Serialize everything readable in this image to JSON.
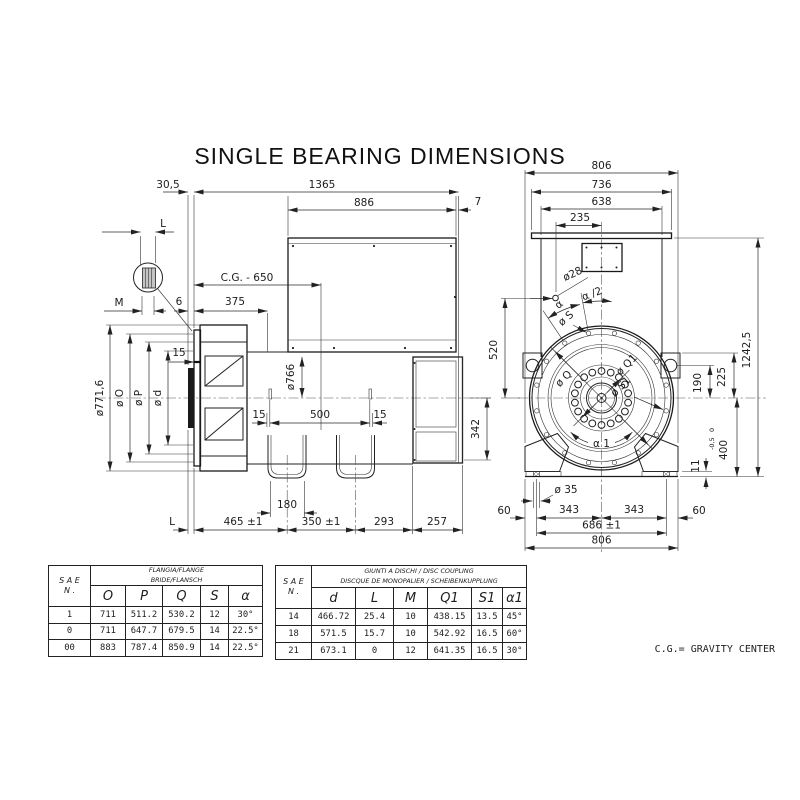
{
  "title": "SINGLE BEARING DIMENSIONS",
  "footer_note": "C.G.= GRAVITY CENTER",
  "side_view": {
    "top": {
      "d30": "30,5",
      "d1365": "1365",
      "d886": "886",
      "d7": "7"
    },
    "mid": {
      "cg": "C.G. - 650",
      "d375": "375",
      "d6": "6",
      "m": "M",
      "l_top": "L",
      "d15_flange": "15",
      "dia766": "ø766",
      "d15_l": "15",
      "d500": "500",
      "d15_r": "15",
      "d342": "342"
    },
    "dia": {
      "d771": "ø771,6",
      "dO": "ø O",
      "dP": "ø P",
      "dd": "ø d"
    },
    "bottom": {
      "d180": "180",
      "l": "L",
      "d465": "465 ±1",
      "d350": "350 ±1",
      "d293": "293",
      "d257": "257"
    }
  },
  "front_view": {
    "top": {
      "d806": "806",
      "d736": "736",
      "d638": "638",
      "d235": "235"
    },
    "left": {
      "dia28": "ø28",
      "d520": "520"
    },
    "angles": {
      "a2": "α /2",
      "a": "α",
      "dS": "ø S",
      "a1": "α 1"
    },
    "flange": {
      "dQ": "ø Q",
      "dQ1": "ø Q1",
      "dS1": "ø S1"
    },
    "right": {
      "d1242": "1242,5",
      "d225": "225",
      "d190": "190",
      "d400": "400",
      "t0": "0",
      "tm": "-0,5",
      "d11": "11"
    },
    "bottom": {
      "dia35": "ø 35",
      "d60l": "60",
      "d343l": "343",
      "d343r": "343",
      "d60r": "60",
      "d686": "686 ±1",
      "d806": "806"
    }
  },
  "flange_table": {
    "corner_top": "S A E",
    "corner_bottom": "N .",
    "header_line1": "FLANGIA/FLANGE",
    "header_line2": "BRIDE/FLANSCH",
    "columns": [
      "O",
      "P",
      "Q",
      "S",
      "α"
    ],
    "rows": [
      [
        "1",
        "711",
        "511.2",
        "530.2",
        "12",
        "30°"
      ],
      [
        "0",
        "711",
        "647.7",
        "679.5",
        "14",
        "22.5°"
      ],
      [
        "00",
        "883",
        "787.4",
        "850.9",
        "14",
        "22.5°"
      ]
    ]
  },
  "coupling_table": {
    "corner_top": "S A E",
    "corner_bottom": "N .",
    "header_line1": "GIUNTI A DISCHI / DISC COUPLING",
    "header_line2": "DISCQUE DE MONOPALIER / SCHEIBENKUPPLUNG",
    "columns": [
      "d",
      "L",
      "M",
      "Q1",
      "S1",
      "α1"
    ],
    "rows": [
      [
        "14",
        "466.72",
        "25.4",
        "10",
        "438.15",
        "13.5",
        "45°"
      ],
      [
        "18",
        "571.5",
        "15.7",
        "10",
        "542.92",
        "16.5",
        "60°"
      ],
      [
        "21",
        "673.1",
        "0",
        "12",
        "641.35",
        "16.5",
        "30°"
      ]
    ]
  }
}
